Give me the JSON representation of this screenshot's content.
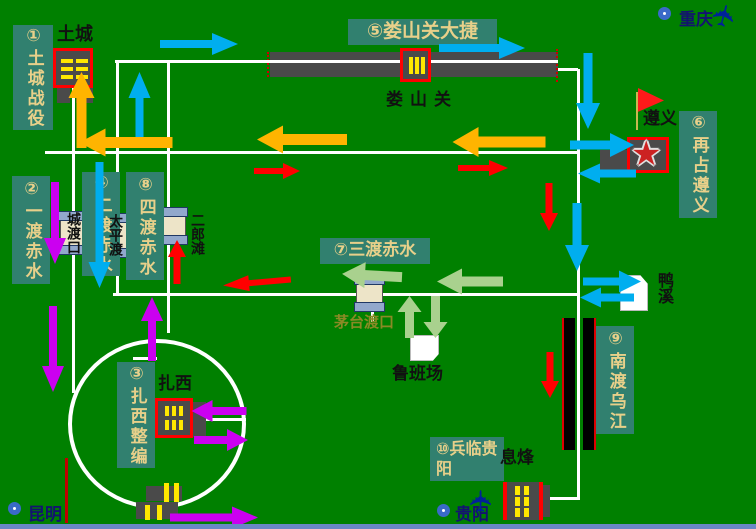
{
  "map_title": "四渡赤水战役示意图",
  "colors": {
    "background": "#008000",
    "label_bg": "#31806F",
    "label_text": "#E8D08A",
    "cyan": "#00AEEF",
    "orange": "#FFB400",
    "red": "#FF0000",
    "magenta": "#CB00F0",
    "green": "#A9D18E"
  },
  "icons": {
    "star": "★",
    "plane": "✈",
    "flag": "red-flag",
    "city_marker": "blue-ring"
  },
  "events": [
    {
      "label": "①土城战役",
      "o": "v",
      "box": [
        13,
        25,
        40,
        105
      ],
      "fs": 17
    },
    {
      "label": "②一渡赤水",
      "o": "v",
      "box": [
        12,
        176,
        38,
        108
      ],
      "fs": 17
    },
    {
      "label": "③扎西整编",
      "o": "v",
      "box": [
        117,
        362,
        38,
        106
      ],
      "fs": 17
    },
    {
      "label": "④二渡赤水",
      "o": "v",
      "box": [
        82,
        172,
        38,
        104
      ],
      "fs": 17
    },
    {
      "label": "⑤娄山关大捷",
      "o": "h",
      "box": [
        348,
        19,
        149,
        26
      ],
      "fs": 19
    },
    {
      "label": "⑥再占遵义",
      "o": "v",
      "box": [
        679,
        111,
        38,
        107
      ],
      "fs": 17
    },
    {
      "label": "⑦三渡赤水",
      "o": "h",
      "box": [
        320,
        238,
        110,
        26
      ],
      "fs": 17
    },
    {
      "label": "⑧四渡赤水",
      "o": "v",
      "box": [
        126,
        172,
        38,
        108
      ],
      "fs": 17
    },
    {
      "label": "⑨南渡乌江",
      "o": "v",
      "box": [
        596,
        326,
        38,
        108
      ],
      "fs": 17
    },
    {
      "label": "⑩兵临贵阳",
      "o": "w",
      "box": [
        430,
        437,
        74,
        44
      ],
      "fs": 16
    }
  ],
  "places": [
    {
      "t": "土城",
      "x": 57,
      "y": 20,
      "o": "h",
      "fs": 18,
      "c": "#111"
    },
    {
      "t": "娄山关",
      "x": 386,
      "y": 85,
      "o": "h",
      "fs": 17,
      "c": "#111",
      "ls": 7
    },
    {
      "t": "遵义",
      "x": 643,
      "y": 104,
      "o": "h",
      "fs": 17,
      "c": "#111"
    },
    {
      "t": "城渡口",
      "x": 63,
      "y": 212,
      "o": "v",
      "fs": 14,
      "c": "#111"
    },
    {
      "t": "太平渡",
      "x": 105,
      "y": 214,
      "o": "v",
      "fs": 14,
      "c": "#111"
    },
    {
      "t": "二郎滩",
      "x": 187,
      "y": 213,
      "o": "v",
      "fs": 14,
      "c": "#111"
    },
    {
      "t": "茅台渡口",
      "x": 334,
      "y": 311,
      "o": "h",
      "fs": 15,
      "c": "#8a8a25"
    },
    {
      "t": "鲁班场",
      "x": 392,
      "y": 359,
      "o": "h",
      "fs": 17,
      "c": "#111"
    },
    {
      "t": "鸭溪",
      "x": 652,
      "y": 272,
      "o": "v",
      "fs": 16,
      "c": "#111"
    },
    {
      "t": "扎西",
      "x": 158,
      "y": 369,
      "o": "h",
      "fs": 17,
      "c": "#111"
    },
    {
      "t": "息烽",
      "x": 500,
      "y": 443,
      "o": "h",
      "fs": 17,
      "c": "#111"
    }
  ],
  "cities": [
    {
      "name": "重庆",
      "ring": [
        658,
        7
      ],
      "text": [
        679,
        5
      ],
      "plane": [
        713,
        1
      ],
      "planeRot": -75
    },
    {
      "name": "贵阳",
      "ring": [
        437,
        504
      ],
      "text": [
        455,
        500
      ],
      "plane": [
        470,
        486
      ],
      "planeRot": -90
    },
    {
      "name": "昆明",
      "ring": [
        8,
        502
      ],
      "text": [
        28,
        500
      ],
      "plane": null,
      "planeRot": 0
    }
  ],
  "roads": [
    [
      115,
      61,
      558,
      61
    ],
    [
      558,
      69,
      578,
      69
    ],
    [
      578,
      69,
      578,
      500
    ],
    [
      45,
      152,
      578,
      152
    ],
    [
      73,
      88,
      73,
      393
    ],
    [
      117,
      62,
      117,
      294
    ],
    [
      168,
      62,
      168,
      333
    ],
    [
      113,
      294,
      580,
      294
    ],
    [
      372,
      294,
      372,
      322
    ],
    [
      192,
      419,
      246,
      419
    ],
    [
      133,
      358,
      157,
      358
    ],
    [
      542,
      498,
      578,
      498
    ]
  ],
  "arrows": [
    {
      "x": 199,
      "y": 44,
      "l": 78,
      "a": 0,
      "c": "cyan",
      "s": 1.15
    },
    {
      "x": 139,
      "y": 107,
      "l": 70,
      "a": -90,
      "c": "cyan",
      "s": 1.2
    },
    {
      "x": 482,
      "y": 48,
      "l": 86,
      "a": 0,
      "c": "cyan",
      "s": 1.15
    },
    {
      "x": 588,
      "y": 91,
      "l": 76,
      "a": 90,
      "c": "cyan",
      "s": 1.25
    },
    {
      "x": 602,
      "y": 145,
      "l": 64,
      "a": 0,
      "c": "cyan",
      "s": 1.25
    },
    {
      "x": 607,
      "y": 174,
      "l": 58,
      "a": 180,
      "c": "cyan",
      "s": 1.1
    },
    {
      "x": 577,
      "y": 237,
      "l": 68,
      "a": 90,
      "c": "cyan",
      "s": 1.25
    },
    {
      "x": 612,
      "y": 281,
      "l": 58,
      "a": 0,
      "c": "cyan",
      "s": 1.2
    },
    {
      "x": 607,
      "y": 298,
      "l": 54,
      "a": 180,
      "c": "cyan",
      "s": 1.1
    },
    {
      "x": 100,
      "y": 225,
      "l": 126,
      "a": 90,
      "c": "cyan",
      "s": 1.2
    },
    {
      "x": 81,
      "y": 110,
      "l": 76,
      "a": -90,
      "c": "orange",
      "s": 1.4
    },
    {
      "x": 126,
      "y": 143,
      "l": 93,
      "a": 180,
      "c": "orange",
      "s": 1.5
    },
    {
      "x": 302,
      "y": 140,
      "l": 90,
      "a": 180,
      "c": "orange",
      "s": 1.5
    },
    {
      "x": 499,
      "y": 142,
      "l": 93,
      "a": 180,
      "c": "orange",
      "s": 1.6
    },
    {
      "x": 277,
      "y": 171,
      "l": 46,
      "a": 0,
      "c": "red",
      "s": 0.85
    },
    {
      "x": 483,
      "y": 168,
      "l": 50,
      "a": 0,
      "c": "red",
      "s": 0.85
    },
    {
      "x": 549,
      "y": 207,
      "l": 48,
      "a": 90,
      "c": "red",
      "s": 0.95
    },
    {
      "x": 177,
      "y": 262,
      "l": 44,
      "a": -90,
      "c": "red",
      "s": 0.95
    },
    {
      "x": 257,
      "y": 283,
      "l": 68,
      "a": 175,
      "c": "red",
      "s": 0.9
    },
    {
      "x": 550,
      "y": 375,
      "l": 46,
      "a": 90,
      "c": "red",
      "s": 0.95
    },
    {
      "x": 55,
      "y": 223,
      "l": 82,
      "a": 90,
      "c": "magenta",
      "s": 1.15
    },
    {
      "x": 53,
      "y": 349,
      "l": 86,
      "a": 90,
      "c": "magenta",
      "s": 1.15
    },
    {
      "x": 152,
      "y": 329,
      "l": 64,
      "a": -90,
      "c": "magenta",
      "s": 1.15
    },
    {
      "x": 219,
      "y": 411,
      "l": 55,
      "a": 180,
      "c": "magenta",
      "s": 1.15
    },
    {
      "x": 221,
      "y": 440,
      "l": 54,
      "a": 0,
      "c": "magenta",
      "s": 1.15
    },
    {
      "x": 214,
      "y": 517,
      "l": 88,
      "a": 0,
      "c": "magenta",
      "s": 1.2
    },
    {
      "x": 372,
      "y": 276,
      "l": 60,
      "a": 183,
      "c": "green",
      "s": 1.4
    },
    {
      "x": 470,
      "y": 282,
      "l": 66,
      "a": 180,
      "c": "green",
      "s": 1.4
    },
    {
      "x": 409,
      "y": 317,
      "l": 42,
      "a": -90,
      "c": "green",
      "s": 1.3
    },
    {
      "x": 436,
      "y": 317,
      "l": 42,
      "a": 90,
      "c": "green",
      "s": 1.3
    }
  ]
}
